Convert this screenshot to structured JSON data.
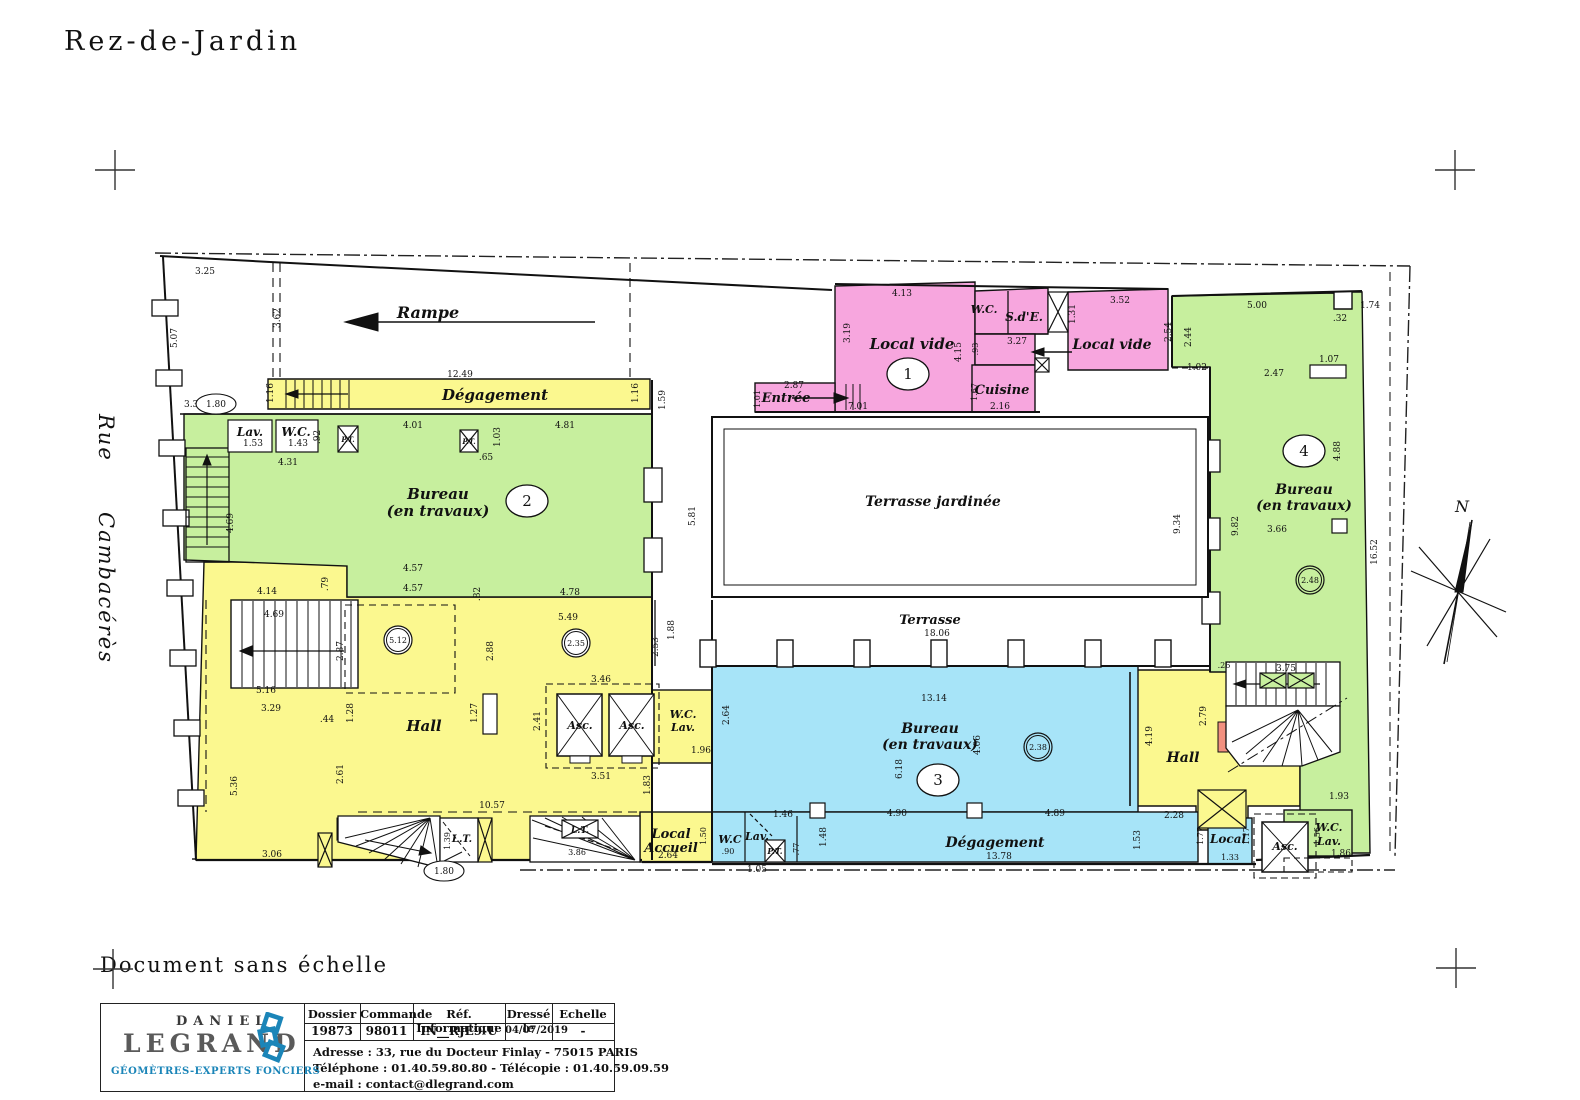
{
  "page": {
    "title": "Rez-de-Jardin",
    "note": "Document sans échelle",
    "street_1": "Rue",
    "street_2": "Cambacérès",
    "north": "N"
  },
  "colors": {
    "yellow": "#fbf88f",
    "green": "#c7ef9e",
    "blue": "#a7e4f8",
    "pink": "#f7a6de",
    "red": "#f2907f",
    "brand_blue": "#1b85b8"
  },
  "rl": [
    "Rampe",
    "Dégagement",
    "Lav.",
    "W.C.",
    "Bureau",
    "(en travaux)",
    "Local vide",
    "W.C.",
    "S.d'E.",
    "Cuisine",
    "Local vide",
    "Entrée",
    "Terrasse jardinée",
    "Terrasse",
    "Bureau",
    "(en travaux)",
    "Hall",
    "Asc.",
    "Asc.",
    "W.C.",
    "Lav.",
    "Local",
    "Accueil",
    "L.T.",
    "L.T.",
    "W.C",
    "Lav.",
    "P.T.",
    "Bureau",
    "(en travaux)",
    "Dégagement",
    "Hall",
    "Local",
    "Asc.",
    "W.C.",
    "Lav.",
    "P.T.",
    "P.T."
  ],
  "numbers": [
    "1",
    "2",
    "3",
    "4"
  ],
  "columns": [
    "5.12",
    "2.35",
    "2.38",
    "2.48"
  ],
  "ovals": [
    "1.80",
    "1.80"
  ],
  "dims": [
    "3.25",
    "5.07",
    "3.62",
    "12.49",
    "1.16",
    "1.16",
    "1.59",
    "3.38",
    "1.53",
    "1.43",
    ".92",
    "4.31",
    "4.01",
    "1.03",
    "4.81",
    ".65",
    "5.81",
    "4.69",
    "4.14",
    ".79",
    "4.57",
    "4.57",
    ".82",
    "4.78",
    "5.49",
    "2.53",
    "1.88",
    "4.69",
    "5.16",
    "2.87",
    "2.88",
    "3.46",
    "2.41",
    "3.51",
    "1.27",
    "1.28",
    ".44",
    "3.29",
    "2.61",
    "5.36",
    "3.06",
    "10.57",
    "1.83",
    "1.39",
    "3.86",
    "2.64",
    "1.96",
    "2.64",
    "1.50",
    ".90",
    "1.05",
    ".77",
    "1.46",
    "1.48",
    "13.14",
    "4.06",
    "6.18",
    "4.90",
    "4.89",
    "13.78",
    "4.13",
    "3.19",
    "4.15",
    "7.01",
    ".93",
    "3.27",
    "1.31",
    "1.67",
    "2.16",
    "3.52",
    "2.54",
    "2.87",
    "1.01",
    "18.06",
    "9.34",
    "5.00",
    ".32",
    "1.74",
    "2.44",
    "1.02",
    "2.47",
    "1.07",
    "4.88",
    "9.82",
    "3.66",
    "16.52",
    ".26",
    "3.75",
    "2.79",
    "4.19",
    "1.93",
    "2.28",
    "1.53",
    "1.77",
    "1.17",
    "1.33",
    "1.56",
    "1.86"
  ],
  "titleblock": {
    "headers": [
      "Dossier",
      "Commande",
      "Réf.  Informatique",
      "Dressé  le",
      "Echelle"
    ],
    "values": [
      "19873",
      "98011",
      "IN__RJE9-U",
      "04/07/2019",
      "-"
    ],
    "address": "Adresse : 33, rue du Docteur Finlay  -  75015 PARIS",
    "phone": "Téléphone : 01.40.59.80.80   -   Télécopie : 01.40.59.09.59",
    "email": "e-mail : contact@dlegrand.com",
    "brand_top": "DANIEL",
    "brand_main": "LEGRAND",
    "brand_tagline": "GÉOMÈTRES-EXPERTS FONCIERS"
  }
}
